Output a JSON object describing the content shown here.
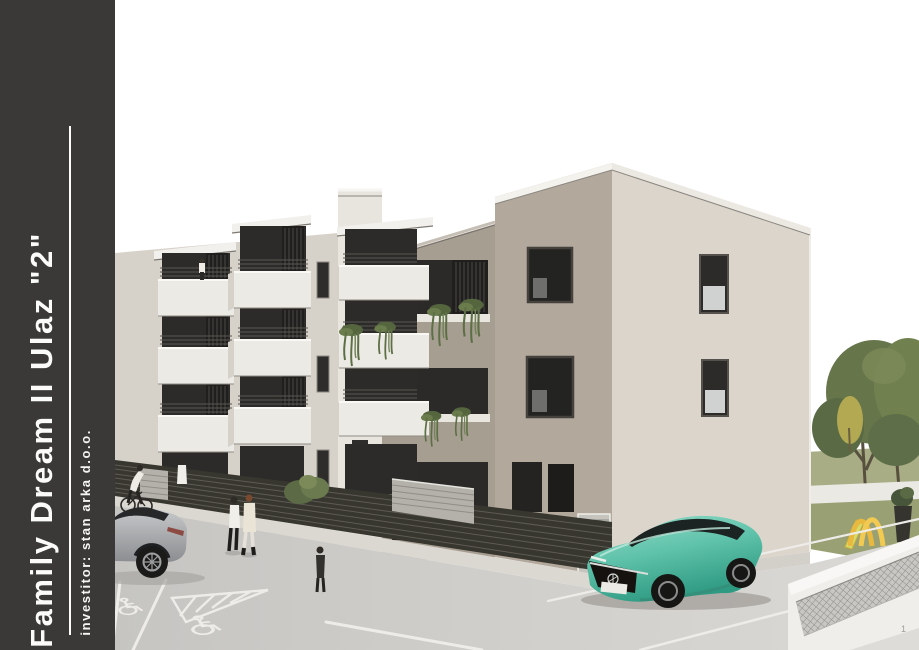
{
  "page": {
    "background": "#ffffff",
    "page_number": "1"
  },
  "sidebar": {
    "title": "Family Dream II Ulaz \"2\"",
    "investor": "investitor: stan arka d.o.o.",
    "bg_color": "#3a3938"
  },
  "header": {
    "year": "2025",
    "designers_label": "Projektanti:",
    "designers": [
      "Milivoj Cota dipl. ing. arh.",
      "Mario Antunović dipl. ing. arh."
    ]
  },
  "logo": {
    "name": "STAN ARKA",
    "tagline": "GRADIMO ZAJEDNO",
    "gold_color": "#b3925f",
    "text_color": "#454440"
  },
  "scene": {
    "subject": "3D exterior render of apartment building Family Dream II, entrance 2",
    "colors": {
      "facade_beige": "#d7d2c9",
      "facade_taupe": "#a79e92",
      "tower_light": "#dcd5cb",
      "balcony_white": "#eceae5",
      "fence_dark": "#37362f",
      "asphalt": "#cbcac7",
      "tree_green": "#66754a",
      "grass": "#99a074",
      "teal_car": "#5fc2aa",
      "suv_silver": "#b4b6b8",
      "slide_yellow": "#e9b83e",
      "marking_white": "#eeece8"
    }
  }
}
